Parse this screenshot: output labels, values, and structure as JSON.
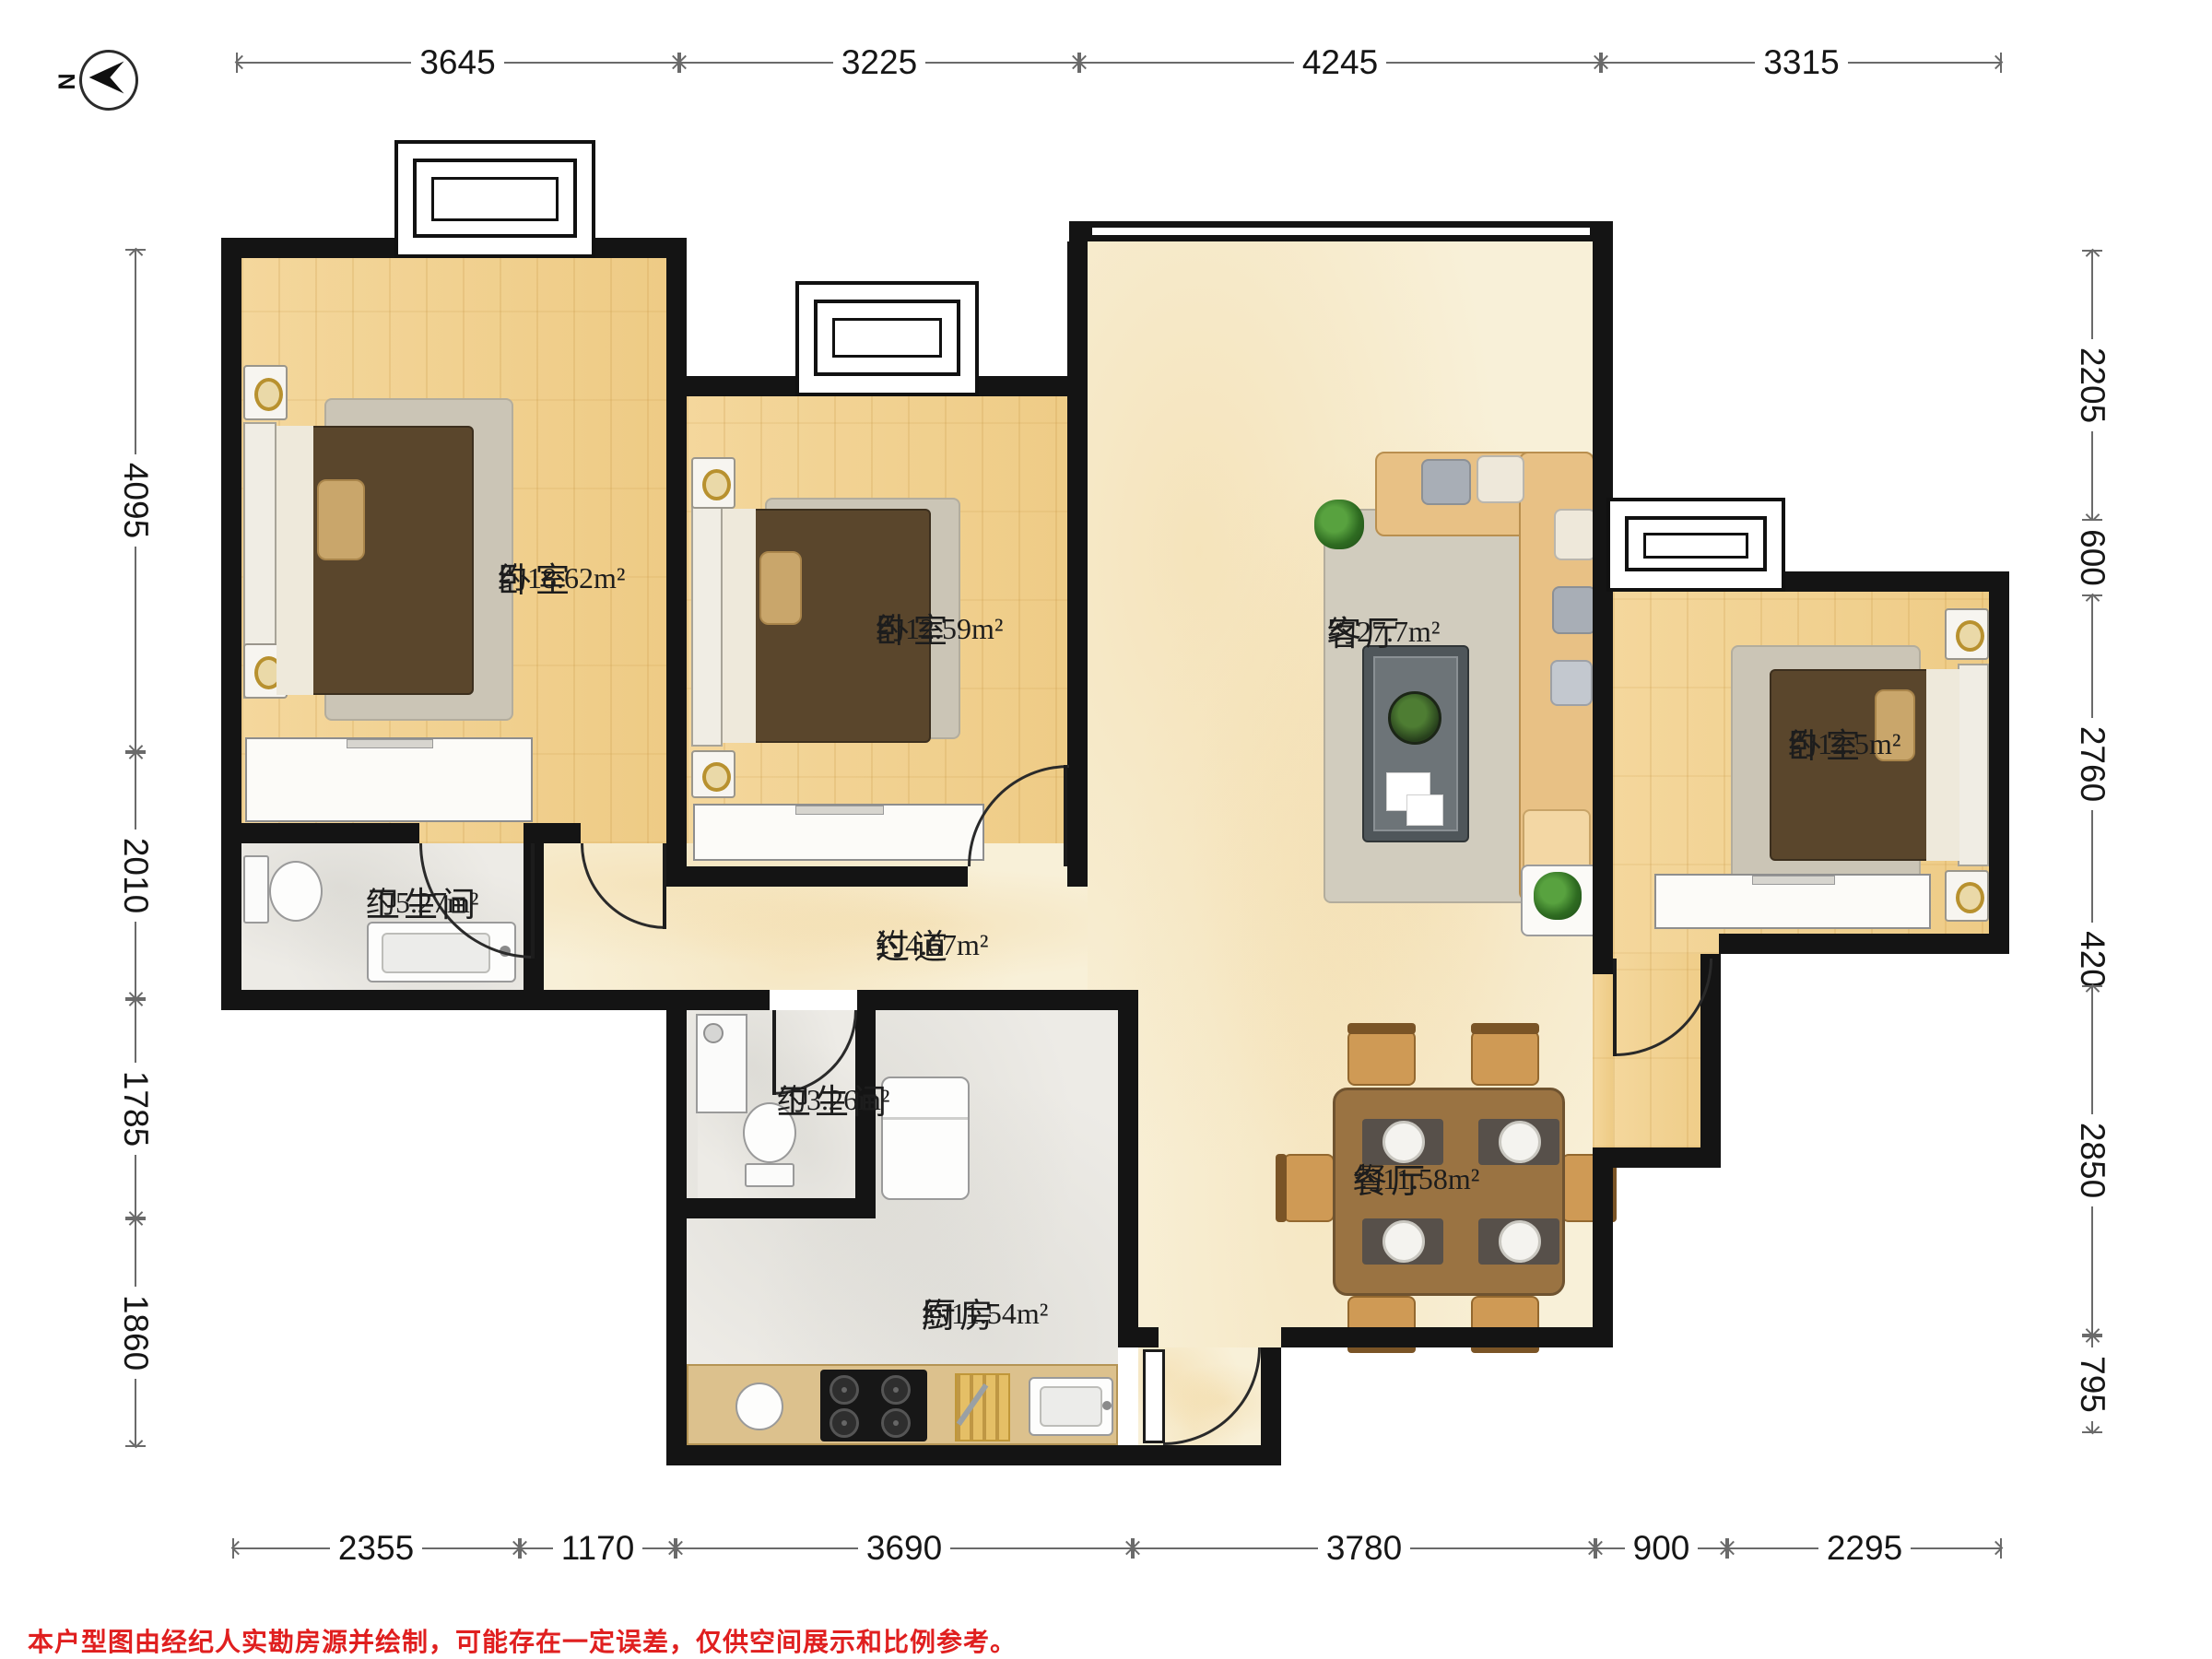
{
  "compass": {
    "north_label": "N"
  },
  "disclaimer": "本户型图由经纪人实勘房源并绘制，可能存在一定误差，仅供空间展示和比例参考。",
  "rooms": [
    {
      "id": "bedroom-1",
      "name": "卧室",
      "area": "约18.62m²",
      "label_x": 540,
      "label_y": 610
    },
    {
      "id": "bedroom-2",
      "name": "卧室",
      "area": "约12.59m²",
      "label_x": 950,
      "label_y": 665
    },
    {
      "id": "living-room",
      "name": "客厅",
      "area": "约27.7m²",
      "label_x": 1440,
      "label_y": 668
    },
    {
      "id": "bedroom-3",
      "name": "卧室",
      "area": "约12.5m²",
      "label_x": 1940,
      "label_y": 790
    },
    {
      "id": "bathroom-1",
      "name": "卫生间",
      "area": "约5.27m²",
      "label_x": 397,
      "label_y": 962
    },
    {
      "id": "hallway",
      "name": "过道",
      "area": "约4.67m²",
      "label_x": 950,
      "label_y": 1008
    },
    {
      "id": "bathroom-2",
      "name": "卫生间",
      "area": "约3.26m²",
      "label_x": 843,
      "label_y": 1176
    },
    {
      "id": "kitchen",
      "name": "厨房",
      "area": "约11.54m²",
      "label_x": 1000,
      "label_y": 1408
    },
    {
      "id": "dining-room",
      "name": "餐厅",
      "area": "约11.58m²",
      "label_x": 1468,
      "label_y": 1262
    }
  ],
  "dimensions": {
    "top": {
      "axis": 68,
      "segments": [
        {
          "label": "3645",
          "from": 256,
          "to": 737
        },
        {
          "label": "3225",
          "from": 737,
          "to": 1171
        },
        {
          "label": "4245",
          "from": 1171,
          "to": 1737
        },
        {
          "label": "3315",
          "from": 1737,
          "to": 2172
        }
      ]
    },
    "bottom": {
      "axis": 1680,
      "segments": [
        {
          "label": "2355",
          "from": 252,
          "to": 564
        },
        {
          "label": "1170",
          "from": 564,
          "to": 733
        },
        {
          "label": "3690",
          "from": 733,
          "to": 1229
        },
        {
          "label": "3780",
          "from": 1229,
          "to": 1731
        },
        {
          "label": "900",
          "from": 1731,
          "to": 1874
        },
        {
          "label": "2295",
          "from": 1874,
          "to": 2172
        }
      ]
    },
    "left": {
      "axis": 147,
      "segments": [
        {
          "label": "4095",
          "from": 270,
          "to": 816
        },
        {
          "label": "2010",
          "from": 816,
          "to": 1084
        },
        {
          "label": "1785",
          "from": 1084,
          "to": 1322
        },
        {
          "label": "1860",
          "from": 1322,
          "to": 1570
        }
      ]
    },
    "right": {
      "axis": 2270,
      "segments": [
        {
          "label": "2205",
          "from": 271,
          "to": 565
        },
        {
          "label": "600",
          "from": 565,
          "to": 645
        },
        {
          "label": "2760",
          "from": 645,
          "to": 1013
        },
        {
          "label": "420",
          "from": 1013,
          "to": 1069
        },
        {
          "label": "2850",
          "from": 1069,
          "to": 1449
        },
        {
          "label": "795",
          "from": 1449,
          "to": 1555
        }
      ]
    }
  },
  "colors": {
    "wall": "#141414",
    "wood_floor": "#f1d194",
    "marble_floor": "#f8f0d8",
    "tile_floor": "#edebe6",
    "dim_line": "#6a6a6a",
    "disclaimer_red": "#e01f1f"
  }
}
